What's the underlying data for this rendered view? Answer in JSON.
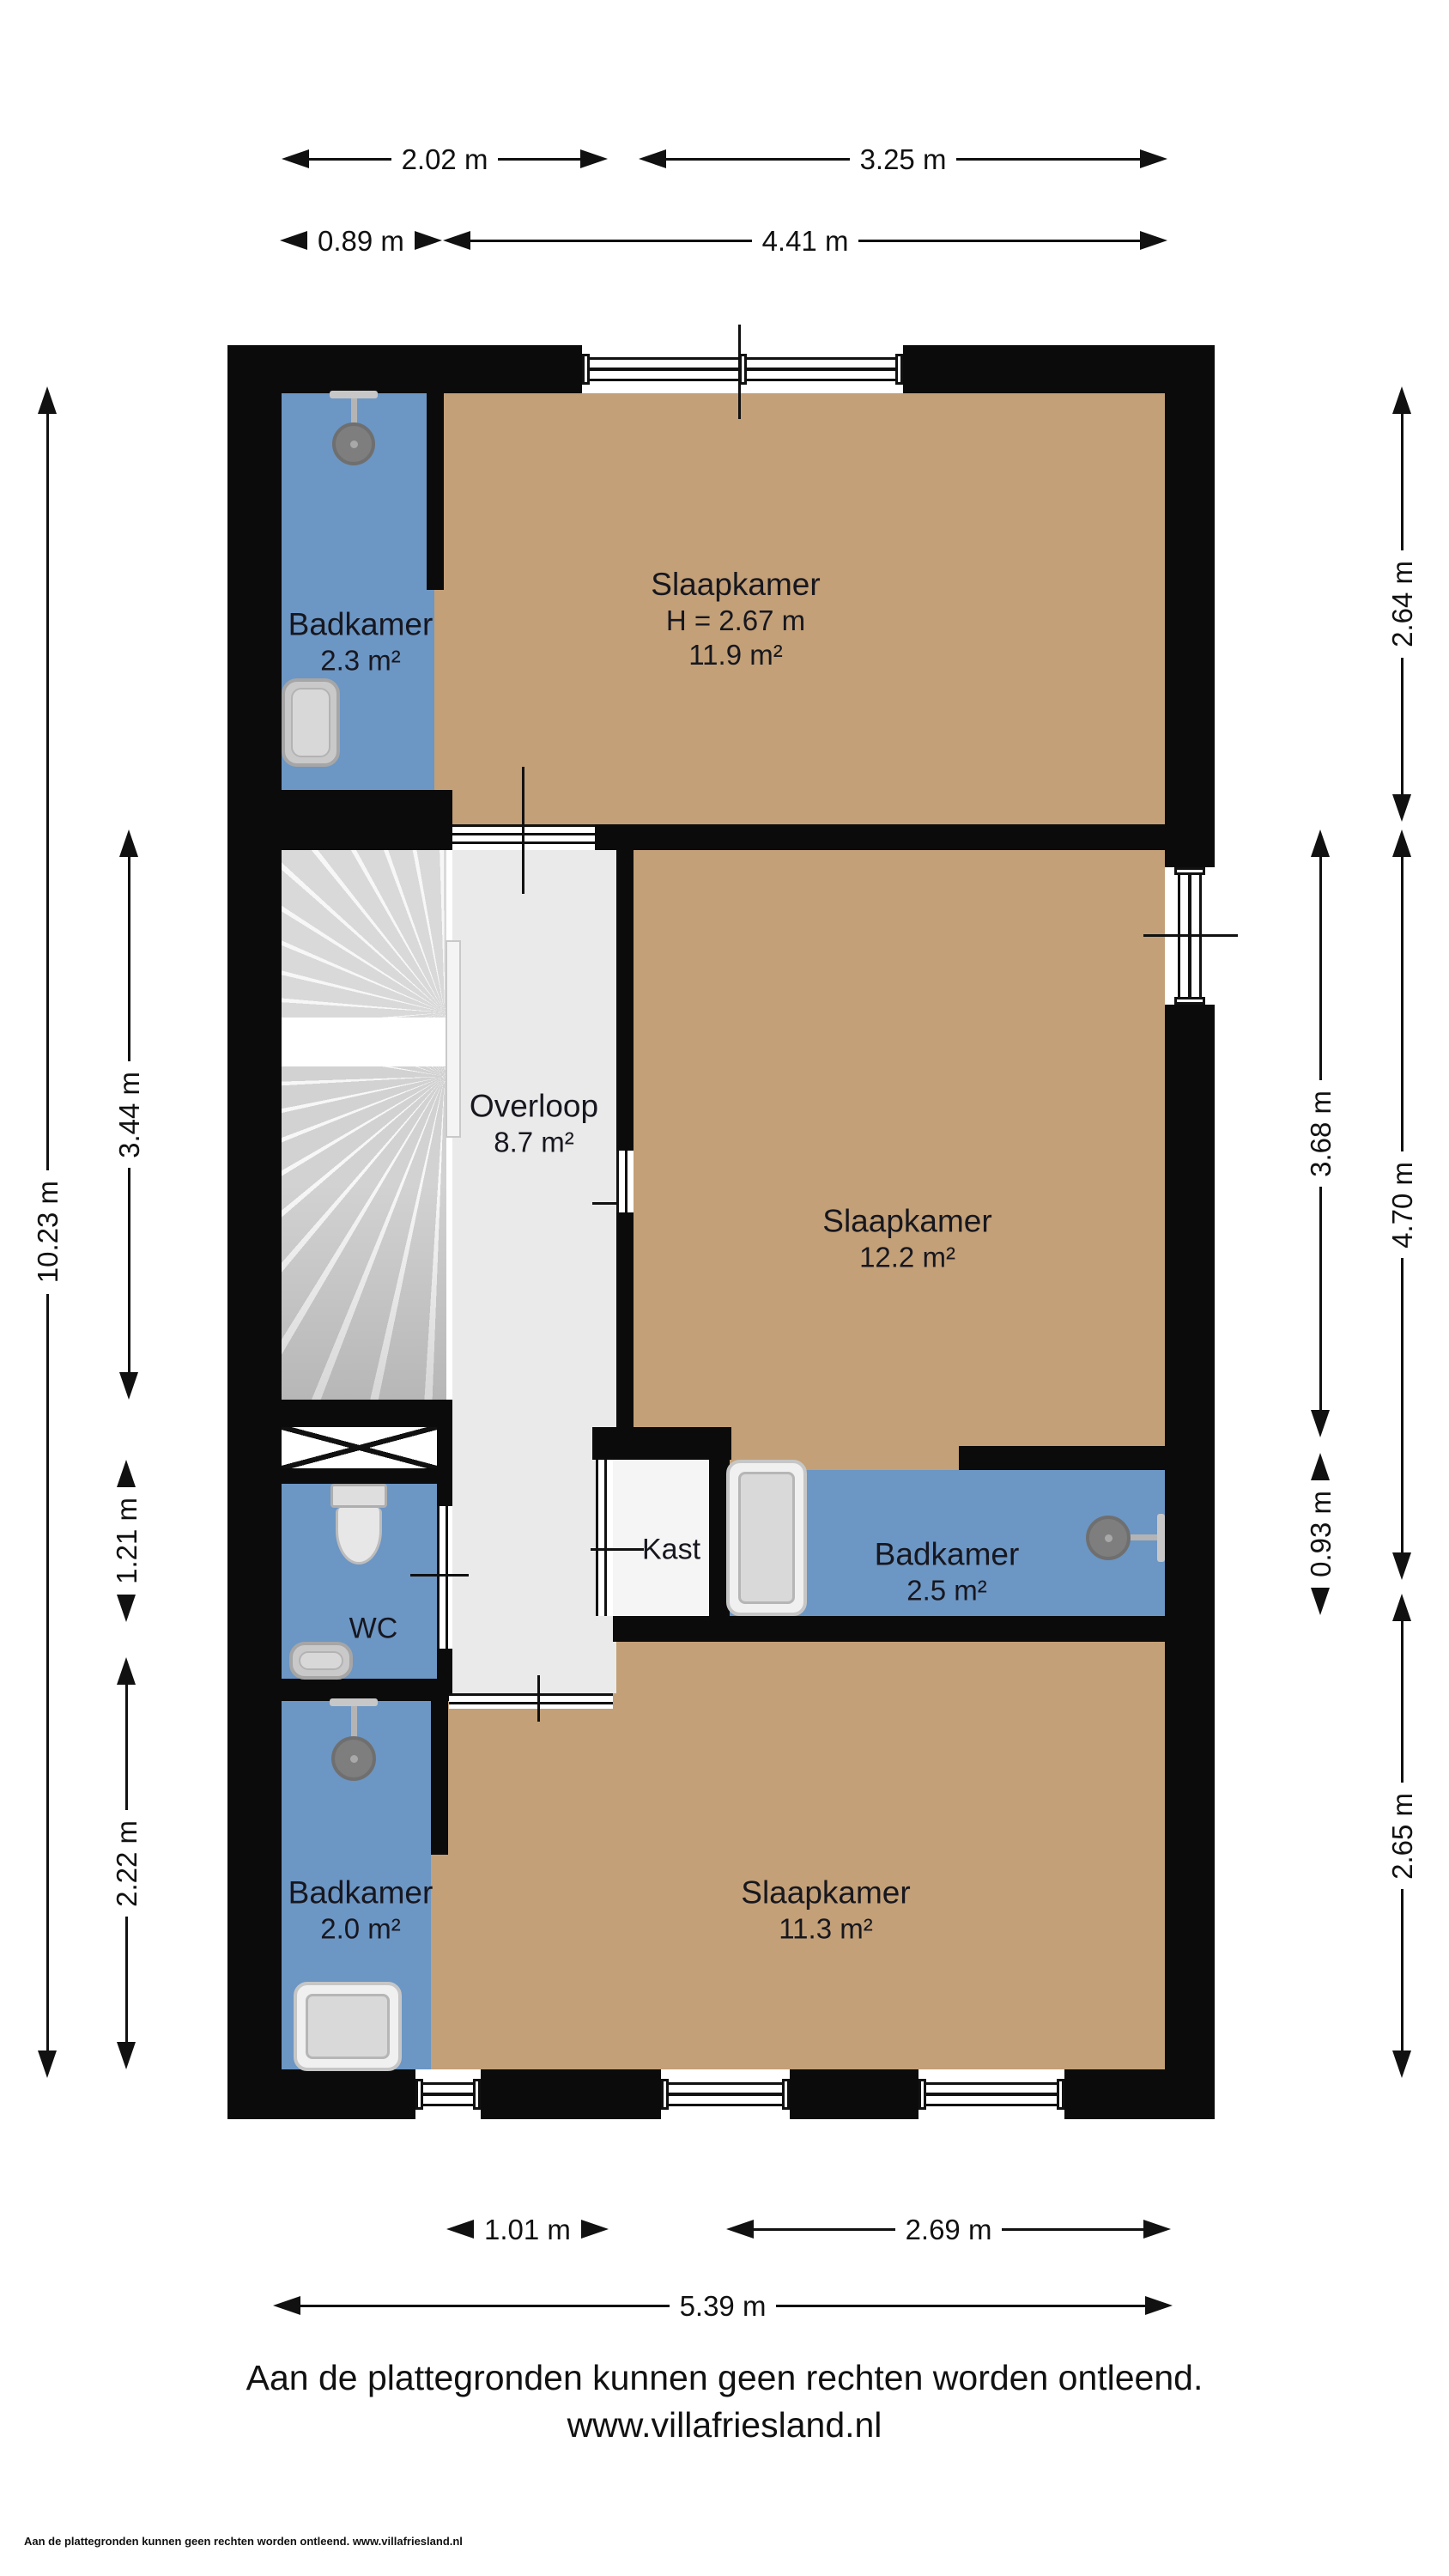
{
  "rooms": [
    {
      "name": "Badkamer",
      "area": "2.3 m²"
    },
    {
      "name": "Slaapkamer",
      "height": "H = 2.67 m",
      "area": "11.9 m²"
    },
    {
      "name": "Overloop",
      "area": "8.7 m²"
    },
    {
      "name": "Slaapkamer",
      "area": "12.2 m²"
    },
    {
      "name": "Kast"
    },
    {
      "name": "Badkamer",
      "area": "2.5 m²"
    },
    {
      "name": "WC"
    },
    {
      "name": "Badkamer",
      "area": "2.0 m²"
    },
    {
      "name": "Slaapkamer",
      "area": "11.3 m²"
    }
  ],
  "dimensions": {
    "top_row1_left": "2.02 m",
    "top_row1_right": "3.25 m",
    "top_row2_left": "0.89 m",
    "top_row2_right": "4.41 m",
    "left_outer": "10.23 m",
    "left_stairs": "3.44 m",
    "left_wc": "1.21 m",
    "left_bottom": "2.22 m",
    "right_top": "2.64 m",
    "right_mid_inner": "3.68 m",
    "right_mid_outer": "4.70 m",
    "right_small": "0.93 m",
    "right_bottom": "2.65 m",
    "bottom_row1_left": "1.01 m",
    "bottom_row1_right": "2.69 m",
    "bottom_row2": "5.39 m"
  },
  "footer": {
    "disclaimer": "Aan de plattegronden kunnen geen rechten worden ontleend.",
    "website": "www.villafriesland.nl",
    "fineprint": "Aan de plattegronden kunnen geen rechten worden ontleend. www.villafriesland.nl"
  },
  "colors": {
    "bedroom_floor": "#c3a077",
    "bathroom_floor": "#6c96c4",
    "hall_floor": "#eaeaea",
    "wall": "#0b0b0b"
  }
}
